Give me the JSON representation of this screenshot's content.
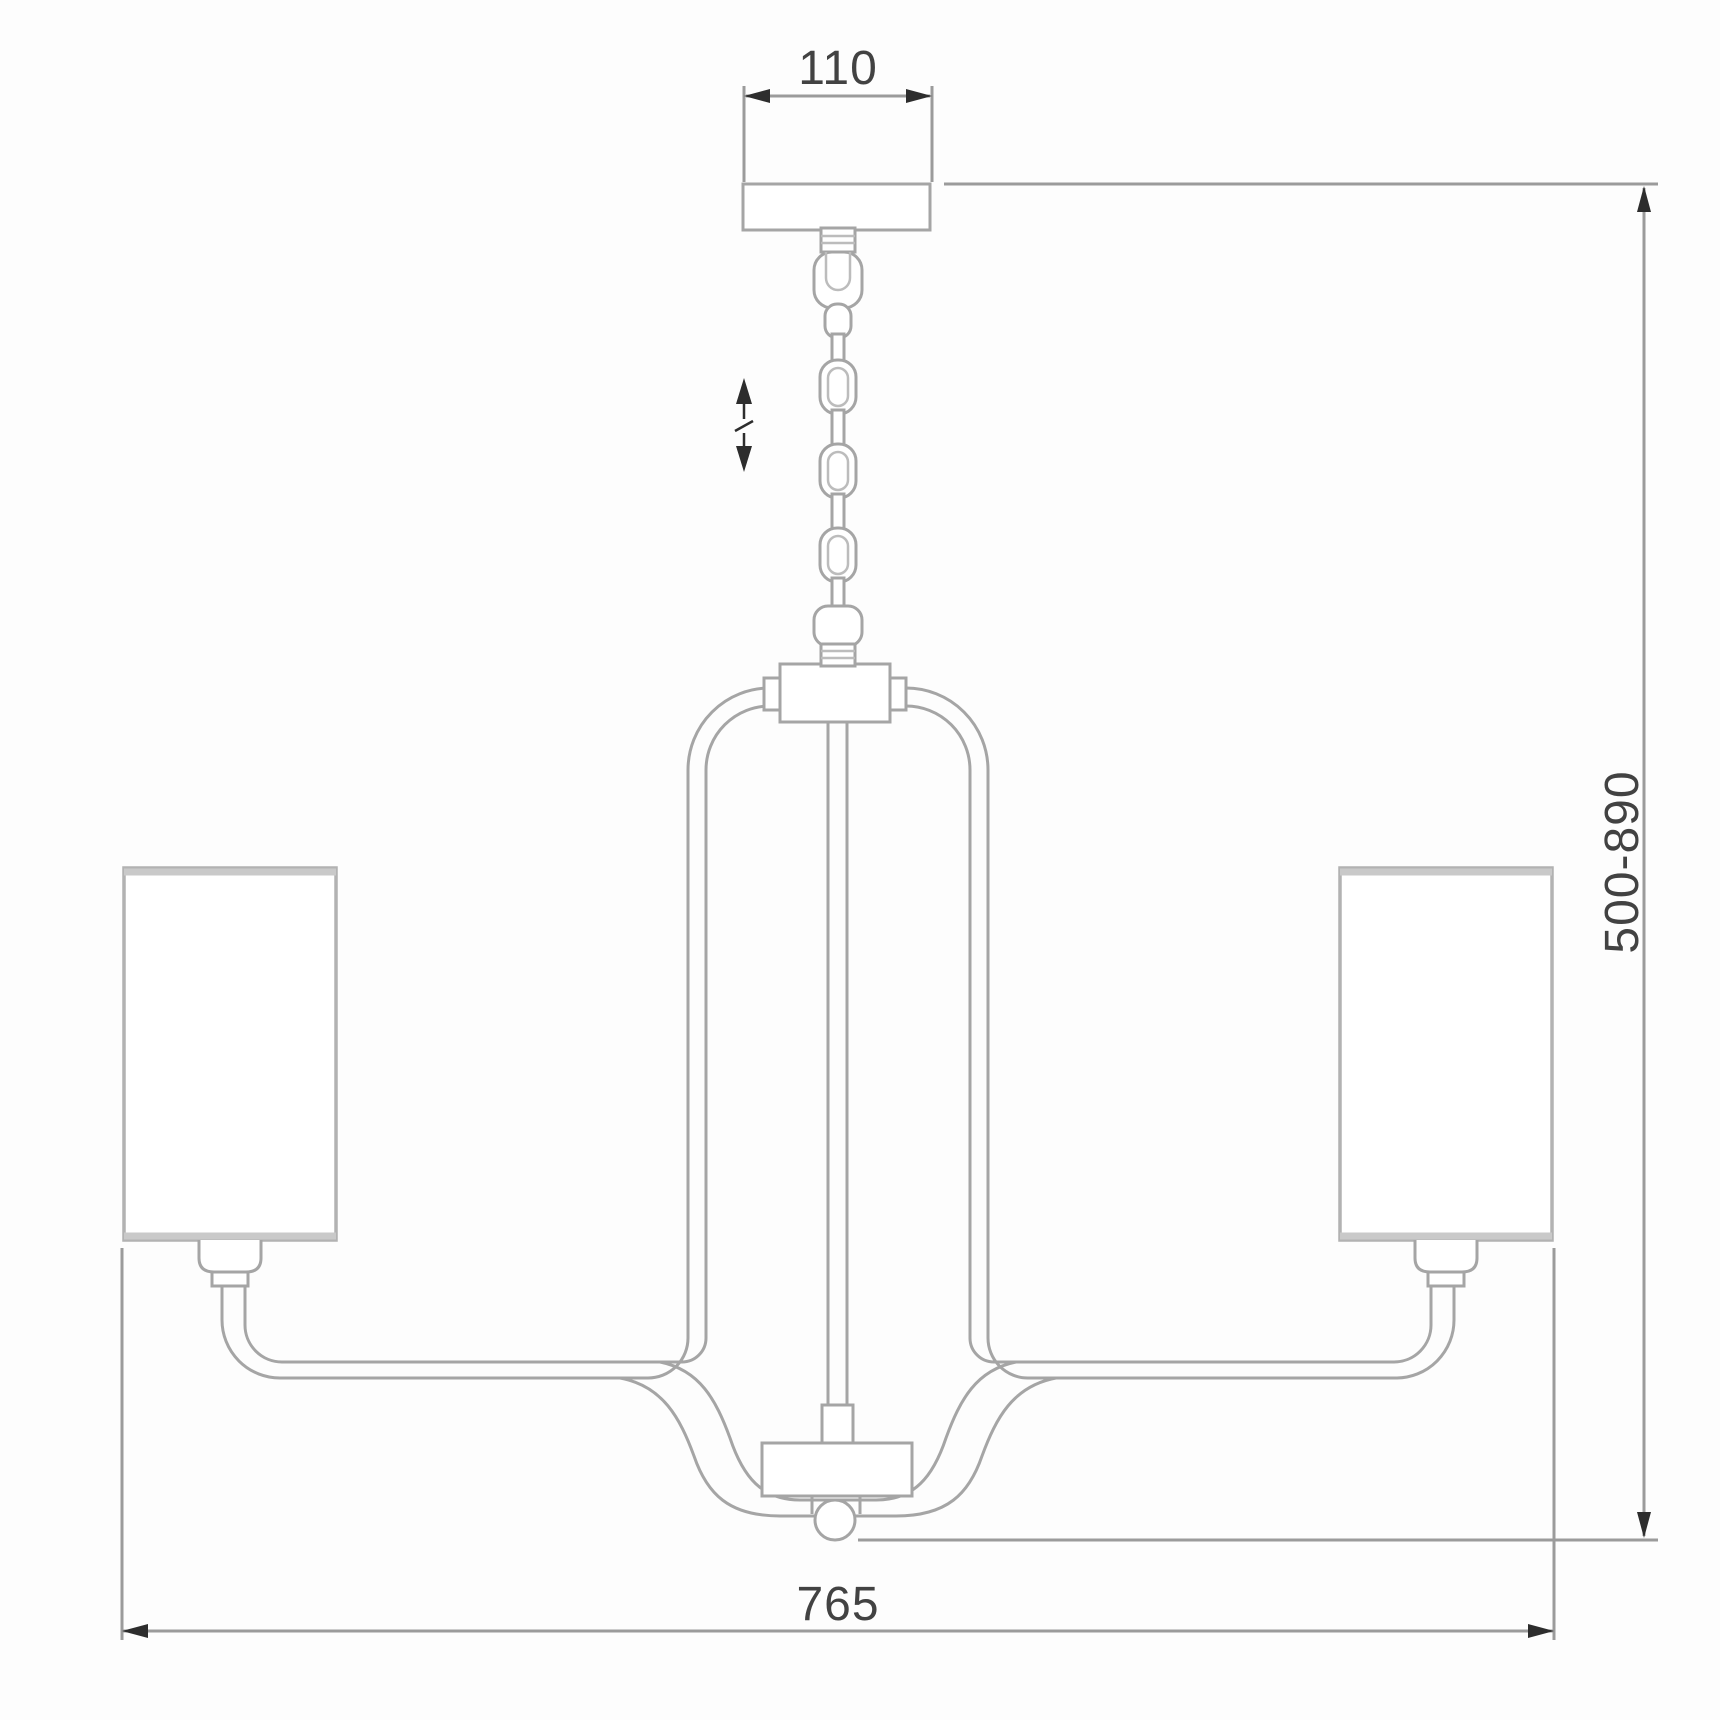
{
  "drawing": {
    "kind": "technical dimension drawing",
    "subject": "chandelier with chain suspension and cylindrical shades",
    "colors": {
      "background": "#fdfdfd",
      "fixture_line": "#a5a5a5",
      "fixture_light": "#bcbcbc",
      "dimension_line": "#9b9b9b",
      "arrow": "#2d2d2d",
      "label_text": "#424242",
      "shade_edge": "#c9c9c9",
      "fill": "#ffffff"
    },
    "dimensions": {
      "canopy_width": {
        "label": "110"
      },
      "overall_height": {
        "label": "500-890"
      },
      "overall_width": {
        "label": "765"
      }
    },
    "icons": {
      "adjustable_height": "double-headed-vertical-arrow-icon",
      "arrowheads": "filled-triangle-dimension-arrowhead-icons"
    }
  }
}
